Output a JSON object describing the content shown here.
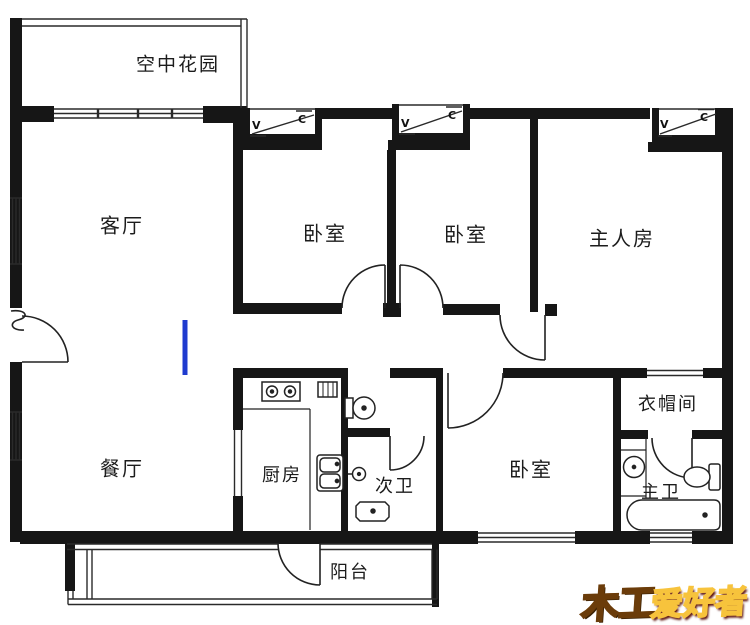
{
  "rooms": {
    "sky_garden": {
      "label": "空中花园"
    },
    "living": {
      "label": "客厅"
    },
    "bedroom1": {
      "label": "卧室"
    },
    "bedroom2": {
      "label": "卧室"
    },
    "master": {
      "label": "主人房"
    },
    "dining": {
      "label": "餐厅"
    },
    "kitchen": {
      "label": "厨房"
    },
    "second_bath": {
      "label": "次卫"
    },
    "bedroom3": {
      "label": "卧室"
    },
    "cloakroom": {
      "label": "衣帽间"
    },
    "master_bath": {
      "label": "主卫"
    },
    "balcony": {
      "label": "阳台"
    }
  },
  "ac_unit": {
    "left_letter": "V",
    "right_letter": "C"
  },
  "watermark": {
    "part1": "木工",
    "part2": "爱好者"
  },
  "colors": {
    "wall": "#161616",
    "annotation_blue": "#1f3bcf",
    "watermark_orange": "#eda22b",
    "watermark_red": "#d41f12"
  }
}
